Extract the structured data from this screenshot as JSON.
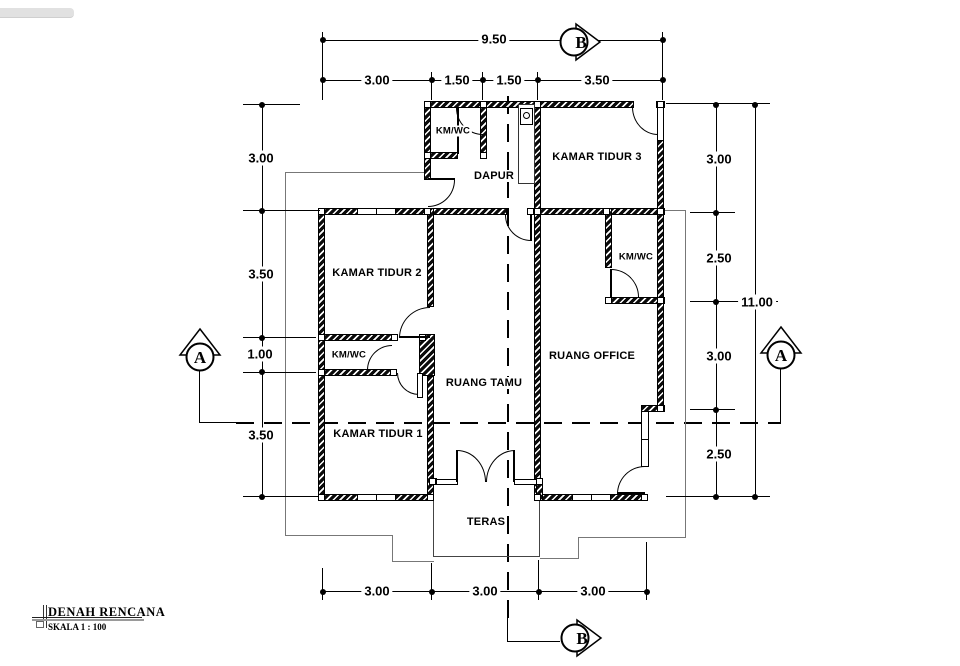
{
  "drawing": {
    "title": "DENAH RENCANA",
    "scale": "SKALA 1 : 100"
  },
  "rooms": {
    "kmwc_top": "KM/WC",
    "dapur": "DAPUR",
    "kamar_tidur_3": "KAMAR TIDUR 3",
    "kamar_tidur_2": "KAMAR TIDUR 2",
    "kmwc_left": "KM/WC",
    "kamar_tidur_1": "KAMAR TIDUR 1",
    "ruang_tamu": "RUANG TAMU",
    "ruang_office": "RUANG OFFICE",
    "kmwc_right": "KM/WC",
    "teras": "TERAS"
  },
  "dimensions": {
    "top_total": "9.50",
    "top": [
      "3.00",
      "1.50",
      "1.50",
      "3.50"
    ],
    "left": [
      "3.00",
      "3.50",
      "1.00",
      "3.50"
    ],
    "right": [
      "3.00",
      "2.50",
      "3.00",
      "2.50"
    ],
    "right_total": "11.00",
    "bottom": [
      "3.00",
      "3.00",
      "3.00"
    ]
  },
  "section_markers": {
    "a": "A",
    "b": "B"
  },
  "colors": {
    "wall": "#0b0b0b",
    "paper": "#ffffff",
    "roofline": "#777777",
    "toolbar_fragment": "#e1e1e1"
  }
}
